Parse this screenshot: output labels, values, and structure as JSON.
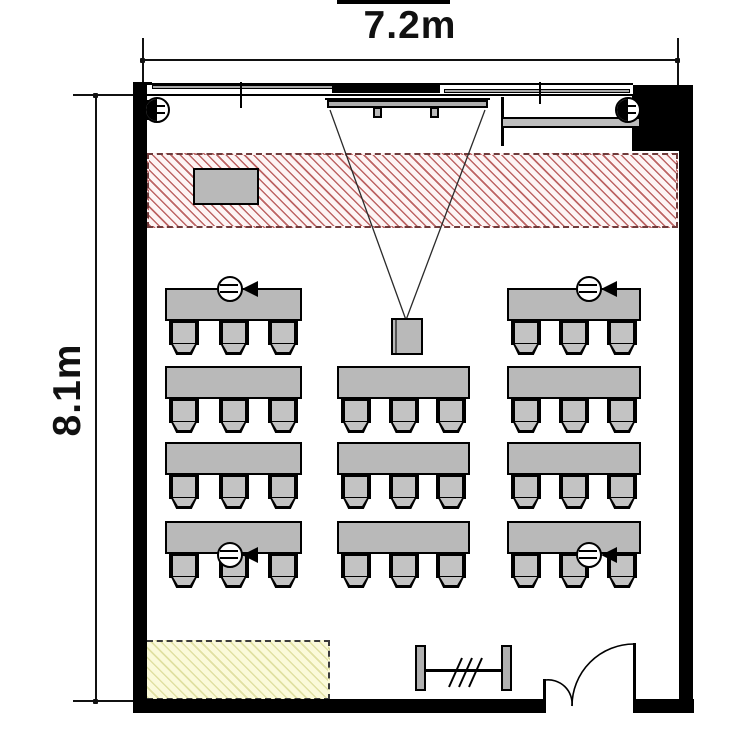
{
  "dimensions": {
    "width_label": "7.2m",
    "depth_label": "8.1m"
  },
  "colors": {
    "wall": "#000000",
    "furniture_fill": "#b9b9b9",
    "chair_fill": "#c3c3c3",
    "projection_zone_stripe": "#bd6464",
    "projection_zone_border": "#6e3a3a",
    "storage_zone_fill": "#fbfada",
    "storage_zone_stripe": "#e0e0a2",
    "line": "#111111"
  },
  "furniture": {
    "desk": {
      "height": 33,
      "fill": "#b9b9b9"
    },
    "chair": {
      "width": 30,
      "height": 35,
      "per_desk": 3,
      "side_margin": 4
    },
    "columns": [
      {
        "id": "left",
        "x": 165,
        "width": 137,
        "rows": [
          1,
          2,
          3,
          4
        ]
      },
      {
        "id": "center",
        "x": 337,
        "width": 133,
        "rows": [
          2,
          3,
          4
        ]
      },
      {
        "id": "right",
        "x": 507,
        "width": 134,
        "rows": [
          1,
          2,
          3,
          4
        ]
      }
    ],
    "row_tops": {
      "1": 288,
      "2": 366,
      "3": 442,
      "4": 521
    },
    "desk_count": 11,
    "seat_count": 33,
    "presenter_desk": {
      "x": 193,
      "y": 168,
      "width": 66,
      "height": 37
    }
  },
  "outlets": {
    "floor": [
      {
        "cx": 230,
        "cy": 289
      },
      {
        "cx": 589,
        "cy": 289
      },
      {
        "cx": 230,
        "cy": 555
      },
      {
        "cx": 589,
        "cy": 555
      }
    ],
    "wall": [
      {
        "cx": 157,
        "cy": 110,
        "mount": "left-wall"
      },
      {
        "cx": 628,
        "cy": 110,
        "mount": "right-column"
      }
    ]
  },
  "equipment_icons": {
    "projector": "ceiling-projector-icon",
    "screen": "roller-screen-icon",
    "whiteboard": "wall-whiteboard-icon",
    "coat_rack": "hanger-rack-icon",
    "door": "double-swing-door-icon",
    "projection_zone": "keep-clear-hatched-zone",
    "storage_zone": "storage-hatched-zone"
  }
}
